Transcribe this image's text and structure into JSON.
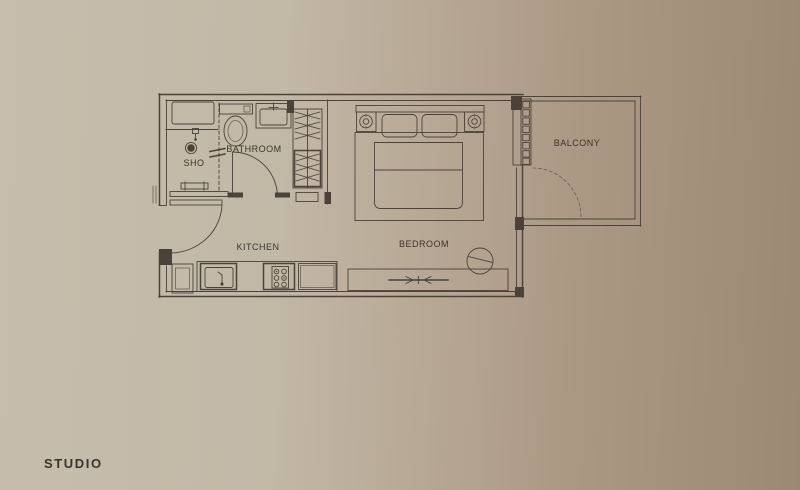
{
  "branding": {
    "plan_type_label": "STUDIO"
  },
  "floorplan": {
    "room_labels": {
      "shower": "SHO",
      "bathroom": "BATHROOM",
      "kitchen": "KITCHEN",
      "bedroom": "BEDROOM",
      "balcony": "BALCONY"
    },
    "colors": {
      "background_left": "#c6bdac",
      "background_right": "#9c8974",
      "line": "#4b433a",
      "line_soft": "#6b6156",
      "text": "#3a342c"
    },
    "fixture_icons": [
      {
        "name": "shower-drain-icon",
        "shape": "filled-circle"
      },
      {
        "name": "shower-head-icon",
        "shape": "small-rect-with-stem"
      },
      {
        "name": "glass-partition-icon",
        "shape": "dashed-line-with-break-ticks"
      },
      {
        "name": "toilet-icon",
        "shape": "tank-rect-plus-oval"
      },
      {
        "name": "washbasin-icon",
        "shape": "rect-with-faucet"
      },
      {
        "name": "wardrobe-rail-icon",
        "shape": "zigzag-lines"
      },
      {
        "name": "kitchen-sink-icon",
        "shape": "rect-with-faucet"
      },
      {
        "name": "stove-burners-icon",
        "shape": "circle-grid"
      },
      {
        "name": "bed-icon",
        "shape": "frame-pillows-duvet"
      },
      {
        "name": "lamp-icon",
        "shape": "concentric-circles"
      },
      {
        "name": "tv-icon",
        "shape": "line-with-inward-arrows"
      },
      {
        "name": "chair-icon",
        "shape": "circle-with-chord"
      },
      {
        "name": "door-swing-icon",
        "shape": "quarter-arc"
      },
      {
        "name": "sliding-door-icon",
        "shape": "segmented-track"
      }
    ]
  }
}
